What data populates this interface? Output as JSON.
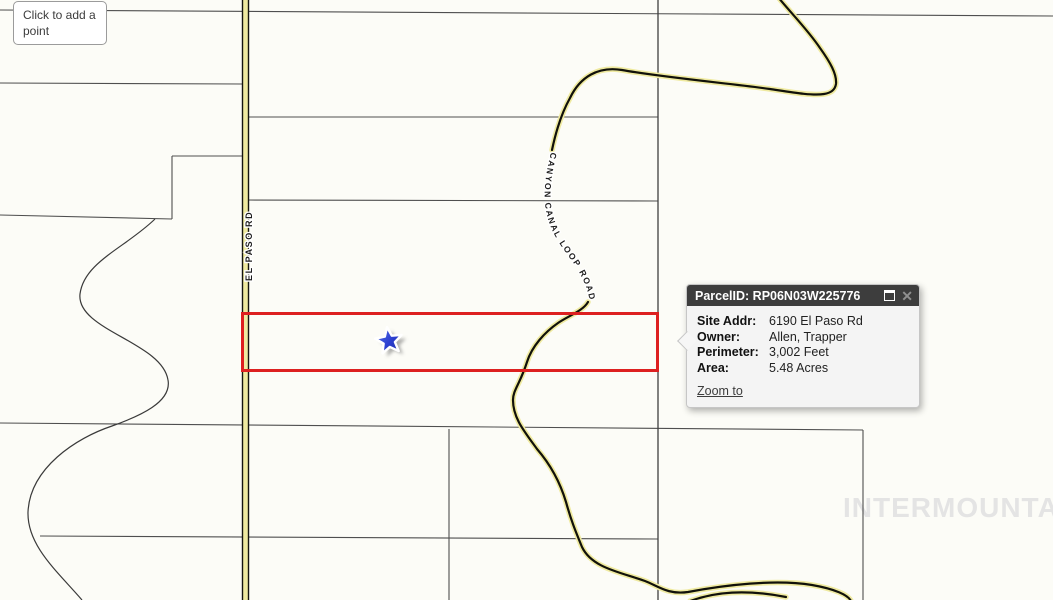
{
  "map": {
    "tooltip_text": "Click to add a point",
    "road_labels": {
      "el_paso": "EL PASO RD",
      "canyon": "CANYON CANAL LOOP ROAD"
    },
    "watermark": "INTERMOUNTAIN",
    "colors": {
      "selection_red": "#dd2020",
      "star_blue": "#2c3fd0",
      "road_halo_yellow": "#efeaa0",
      "parcel_line_gray": "#4f4f4f"
    }
  },
  "popup": {
    "title": "ParcelID: RP06N03W225776",
    "rows": [
      {
        "label": "Site Addr:",
        "value": "6190 El Paso Rd"
      },
      {
        "label": "Owner:",
        "value": "Allen, Trapper"
      },
      {
        "label": "Perimeter:",
        "value": "3,002 Feet"
      },
      {
        "label": "Area:",
        "value": "5.48 Acres"
      }
    ],
    "zoom_link": "Zoom to"
  }
}
